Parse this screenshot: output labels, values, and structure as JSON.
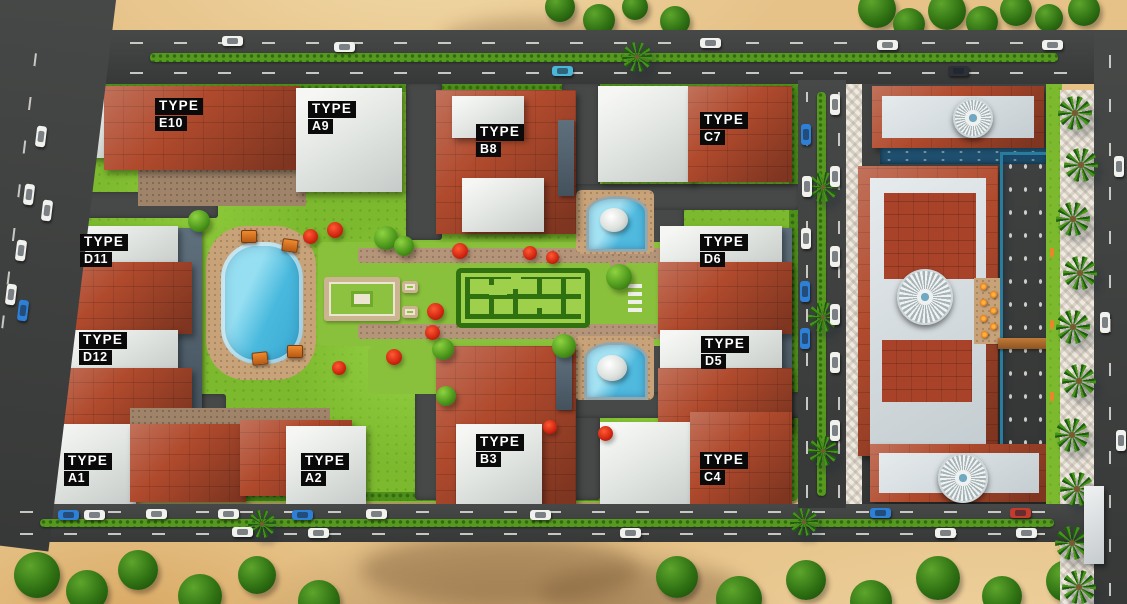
{
  "masterplan": {
    "label_prefix": "TYPE",
    "buildings": [
      {
        "code": "E10"
      },
      {
        "code": "A9"
      },
      {
        "code": "B8"
      },
      {
        "code": "C7"
      },
      {
        "code": "D11"
      },
      {
        "code": "D6"
      },
      {
        "code": "D12"
      },
      {
        "code": "D5"
      },
      {
        "code": "A1"
      },
      {
        "code": "A2"
      },
      {
        "code": "B3"
      },
      {
        "code": "C4"
      }
    ],
    "colors": {
      "roof_red": "#b04a2d",
      "building_white": "#e8ebe8",
      "grass_green": "#7cb92e",
      "pool_blue": "#49b9dd",
      "sand": "#e6c288",
      "road_gray": "#3d3f3e",
      "label_bg": "#0a0a0a",
      "label_text": "#ffffff"
    }
  }
}
